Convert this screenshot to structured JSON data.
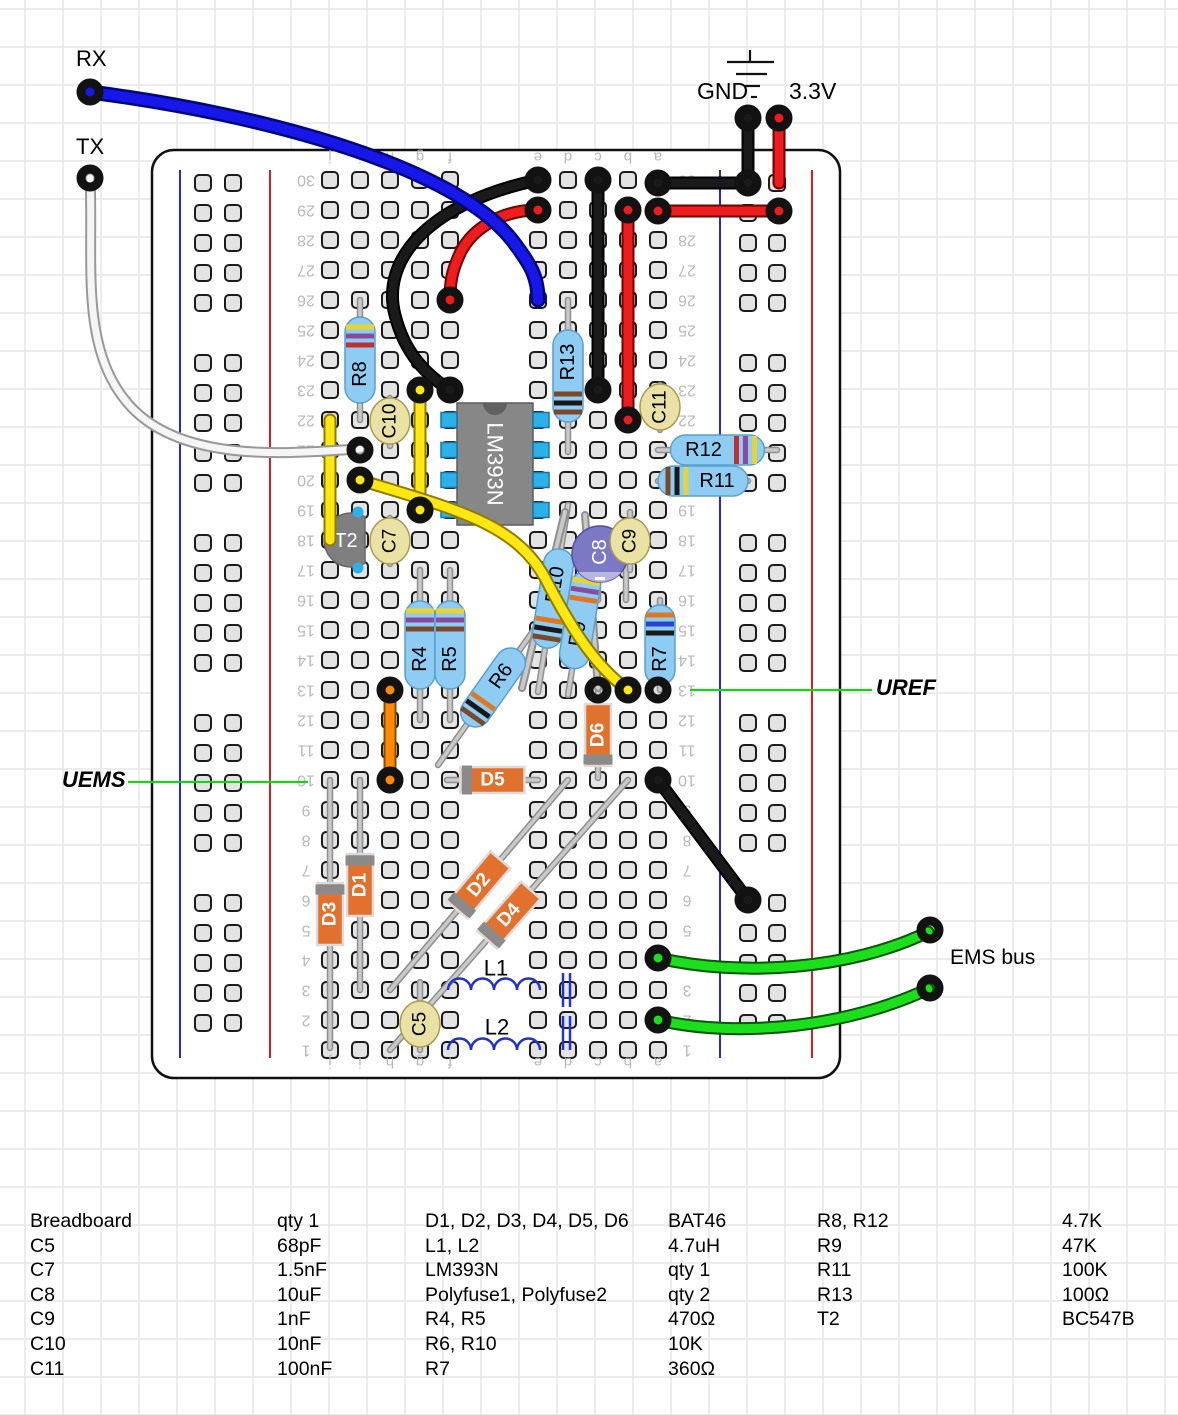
{
  "annotations": {
    "rx": "RX",
    "tx": "TX",
    "gnd": "GND",
    "v33": "3.3V",
    "uems": "UEMS",
    "uref": "UREF",
    "ems_bus": "EMS bus"
  },
  "board": {
    "x": 152,
    "y": 150,
    "w": 688,
    "h": 928,
    "column_letters": [
      "j",
      "i",
      "h",
      "g",
      "f",
      "e",
      "d",
      "c",
      "b",
      "a"
    ],
    "columns_x": [
      330,
      360,
      390,
      420,
      450,
      538,
      568,
      598,
      628,
      658
    ],
    "row_count": 30
  },
  "components": [
    {
      "id": "ic1",
      "kind": "ic",
      "label": "LM393N",
      "x": 457,
      "y": 403,
      "w": 76,
      "h": 122,
      "pinRows": [
        420,
        450,
        480,
        510
      ]
    },
    {
      "id": "r8",
      "kind": "resistor",
      "label": "R8",
      "lead": [
        360,
        300,
        360,
        420
      ],
      "body": 86,
      "bands": [
        "#e8d430",
        "#8b4a9e",
        "#c03030"
      ],
      "bandsAt": "start"
    },
    {
      "id": "r13",
      "kind": "resistor",
      "label": "R13",
      "lead": [
        568,
        300,
        568,
        452
      ],
      "body": 92,
      "bands": [
        "#7a4a28",
        "#191919",
        "#7a4a28"
      ],
      "bandsAt": "end"
    },
    {
      "id": "r12",
      "kind": "resistor",
      "label": "R12",
      "lead": [
        658,
        450,
        777,
        450
      ],
      "body": 94,
      "bands": [
        "#e8d430",
        "#8b4a9e",
        "#c03030"
      ],
      "bandsAt": "end"
    },
    {
      "id": "r11",
      "kind": "resistor",
      "label": "R11",
      "lead": [
        658,
        481,
        748,
        481
      ],
      "body": 90,
      "bands": [
        "#7a4a28",
        "#191919",
        "#e8d430"
      ],
      "bandsAt": "start"
    },
    {
      "id": "r4",
      "kind": "resistor",
      "label": "R4",
      "lead": [
        420,
        570,
        420,
        720
      ],
      "body": 88,
      "bands": [
        "#e8d430",
        "#8b4a9e",
        "#7a4a28"
      ],
      "bandsAt": "start"
    },
    {
      "id": "r5",
      "kind": "resistor",
      "label": "R5",
      "lead": [
        450,
        570,
        450,
        720
      ],
      "body": 88,
      "bands": [
        "#e8d430",
        "#8b4a9e",
        "#7a4a28"
      ],
      "bandsAt": "start"
    },
    {
      "id": "r6",
      "kind": "resistor",
      "label": "R6",
      "lead": [
        438,
        765,
        548,
        610
      ],
      "body": 90,
      "bands": [
        "#7a4a28",
        "#191919",
        "#e07820"
      ],
      "bandsAt": "start"
    },
    {
      "id": "r10",
      "kind": "resistor",
      "label": "R10",
      "lead": [
        568,
        505,
        538,
        692
      ],
      "body": 100,
      "bands": [
        "#7a4a28",
        "#191919",
        "#e07820"
      ],
      "bandsAt": "end"
    },
    {
      "id": "r9",
      "kind": "resistor",
      "label": "R9",
      "lead": [
        592,
        545,
        568,
        695
      ],
      "body": 98,
      "bands": [
        "#e8d430",
        "#8b4a9e",
        "#e07820"
      ],
      "bandsAt": "start"
    },
    {
      "id": "r7",
      "kind": "resistor",
      "label": "R7",
      "lead": [
        660,
        600,
        660,
        690
      ],
      "body": 80,
      "bands": [
        "#e07820",
        "#2743cf",
        "#191919"
      ],
      "bandsAt": "start"
    },
    {
      "id": "d5",
      "kind": "diode",
      "label": "D5",
      "lead": [
        447,
        780,
        538,
        780
      ],
      "body": 64,
      "capAt": "start"
    },
    {
      "id": "d6",
      "kind": "diode",
      "label": "D6",
      "lead": [
        598,
        692,
        598,
        778
      ],
      "body": 62,
      "capAt": "end"
    },
    {
      "id": "d1",
      "kind": "diode",
      "label": "D1",
      "lead": [
        360,
        780,
        360,
        990
      ],
      "body": 62,
      "capAt": "start"
    },
    {
      "id": "d3",
      "kind": "diode",
      "label": "D3",
      "lead": [
        330,
        780,
        330,
        1048
      ],
      "body": 62,
      "capAt": "start"
    },
    {
      "id": "d2",
      "kind": "diode",
      "label": "D2",
      "lead": [
        568,
        780,
        390,
        990
      ],
      "body": 66,
      "capAt": "end"
    },
    {
      "id": "d4",
      "kind": "diode",
      "label": "D4",
      "lead": [
        628,
        780,
        390,
        1050
      ],
      "body": 66,
      "capAt": "end"
    },
    {
      "id": "t2",
      "kind": "transistor",
      "label": "T2",
      "cx": 351,
      "cy": 540,
      "r": 27,
      "dots": [
        [
          358,
          512
        ],
        [
          358,
          568
        ],
        [
          329,
          540
        ]
      ]
    },
    {
      "id": "c8",
      "kind": "ecap",
      "label": "C8",
      "cx": 600,
      "cy": 554,
      "r": 28,
      "leads": [
        [
          598,
          556,
          598,
          600
        ],
        [
          626,
          556,
          626,
          600
        ]
      ]
    },
    {
      "id": "c10",
      "kind": "cap",
      "label": "C10",
      "cx": 390,
      "cy": 421,
      "lead": [
        390,
        398,
        390,
        446
      ]
    },
    {
      "id": "c7",
      "kind": "cap",
      "label": "C7",
      "cx": 390,
      "cy": 541,
      "lead": [
        390,
        518,
        390,
        564
      ]
    },
    {
      "id": "c9",
      "kind": "cap",
      "label": "C9",
      "cx": 630,
      "cy": 541,
      "lead": [
        630,
        512,
        630,
        570
      ]
    },
    {
      "id": "c11",
      "kind": "cap",
      "label": "C11",
      "cx": 660,
      "cy": 407,
      "lead": [
        660,
        385,
        660,
        430
      ]
    },
    {
      "id": "c5",
      "kind": "cap",
      "label": "C5",
      "cx": 420,
      "cy": 1024,
      "lead": [
        420,
        982,
        420,
        1050
      ]
    },
    {
      "id": "polyfuse1",
      "kind": "lead",
      "lead": [
        565,
        512,
        522,
        688
      ]
    },
    {
      "id": "polyfuse2",
      "kind": "lead",
      "lead": [
        585,
        515,
        598,
        688
      ]
    },
    {
      "id": "l1",
      "kind": "inductor",
      "label": "L1",
      "x": 448,
      "y": 990,
      "humps": 4,
      "r": 11.5,
      "bars": [
        563,
        570
      ],
      "barY": [
        973,
        1007
      ],
      "labelAt": [
        496,
        968
      ]
    },
    {
      "id": "l2",
      "kind": "inductor",
      "label": "L2",
      "x": 448,
      "y": 1050,
      "humps": 4,
      "r": 11.5,
      "bars": [
        563,
        570
      ],
      "barY": [
        1016,
        1050
      ],
      "labelAt": [
        497,
        1027
      ]
    }
  ],
  "wires": [
    {
      "id": "black-column-c",
      "color": "black",
      "w": "med",
      "path": "M598,180 L598,390"
    },
    {
      "id": "red-column-b",
      "color": "red",
      "w": "med",
      "path": "M628,210 L628,420"
    },
    {
      "id": "black-top-jumper",
      "color": "black",
      "w": "med",
      "path": "M538,180 C432,202 380,258 395,315 C405,355 428,376 450,390"
    },
    {
      "id": "red-top-jumper",
      "color": "red",
      "w": "med",
      "path": "M538,210 C498,210 468,232 458,258 C452,272 450,282 450,300"
    },
    {
      "id": "black-rail-row30",
      "color": "black",
      "w": "med",
      "path": "M658,183 L748,183"
    },
    {
      "id": "red-rail-row29",
      "color": "red",
      "w": "med",
      "path": "M658,211 L779,211"
    },
    {
      "id": "gnd-pin-wire",
      "color": "black",
      "w": "med",
      "path": "M748,118 L748,183"
    },
    {
      "id": "v33-pin-wire",
      "color": "red",
      "w": "med",
      "path": "M779,118 L779,183"
    },
    {
      "id": "yellow-j-column",
      "color": "yellow",
      "w": "med",
      "path": "M330,420 L330,540"
    },
    {
      "id": "yellow-g-column",
      "color": "yellow",
      "w": "med",
      "path": "M420,390 L420,510"
    },
    {
      "id": "yellow-curve",
      "color": "yellow",
      "w": "med",
      "path": "M360,480 C450,508 515,522 545,578 C567,620 592,664 628,690"
    },
    {
      "id": "orange-jumper",
      "color": "orange",
      "w": "med",
      "path": "M390,690 L390,780"
    },
    {
      "id": "black-diagonal",
      "color": "black",
      "w": "med",
      "path": "M658,780 L748,900"
    },
    {
      "id": "white-tx-wire",
      "color": "white",
      "w": "thin",
      "path": "M90,178 C94,260 78,352 132,408 C188,466 300,452 360,449"
    },
    {
      "id": "blue-rx-wire",
      "color": "blue",
      "w": "thick",
      "path": "M90,92 C270,115 455,168 512,240 C532,266 538,278 538,300"
    },
    {
      "id": "green-ems-top",
      "color": "green",
      "w": "med",
      "path": "M658,958 C740,977 850,970 928,932"
    },
    {
      "id": "green-ems-bottom",
      "color": "green",
      "w": "med",
      "path": "M658,1020 C740,1039 850,1026 928,989"
    }
  ],
  "rings": [
    [
      90,
      92
    ],
    [
      90,
      178
    ],
    [
      748,
      118
    ],
    [
      779,
      118
    ],
    [
      538,
      180
    ],
    [
      538,
      210
    ],
    [
      598,
      180
    ],
    [
      628,
      210
    ],
    [
      658,
      183
    ],
    [
      748,
      183
    ],
    [
      658,
      211
    ],
    [
      779,
      211
    ],
    [
      450,
      300
    ],
    [
      450,
      390
    ],
    [
      420,
      390
    ],
    [
      598,
      390
    ],
    [
      628,
      420
    ],
    [
      360,
      450
    ],
    [
      360,
      480
    ],
    [
      420,
      510
    ],
    [
      390,
      690
    ],
    [
      598,
      690
    ],
    [
      628,
      690
    ],
    [
      658,
      690
    ],
    [
      390,
      780
    ],
    [
      658,
      780
    ],
    [
      748,
      900
    ],
    [
      658,
      958
    ],
    [
      658,
      1020
    ],
    [
      930,
      930
    ],
    [
      930,
      988
    ]
  ],
  "annotation_lines": [
    [
      128,
      782,
      308,
      782
    ],
    [
      690,
      690,
      872,
      690
    ]
  ],
  "parts_list": {
    "groups": [
      {
        "rows": [
          [
            "Breadboard",
            "qty 1"
          ],
          [
            "C5",
            "68pF"
          ],
          [
            "C7",
            "1.5nF"
          ],
          [
            "C8",
            "10uF"
          ],
          [
            "C9",
            "1nF"
          ],
          [
            "C10",
            "10nF"
          ],
          [
            "C11",
            "100nF"
          ]
        ]
      },
      {
        "rows": [
          [
            "D1, D2, D3, D4, D5, D6",
            "BAT46"
          ],
          [
            "L1, L2",
            "4.7uH"
          ],
          [
            "LM393N",
            "qty 1"
          ],
          [
            "Polyfuse1, Polyfuse2",
            "qty 2"
          ],
          [
            "R4, R5",
            "470Ω"
          ],
          [
            "R6, R10",
            "10K"
          ],
          [
            "R7",
            "360Ω"
          ]
        ]
      },
      {
        "rows": [
          [
            "R8, R12",
            "4.7K"
          ],
          [
            "R9",
            "47K"
          ],
          [
            "R11",
            "100K"
          ],
          [
            "R13",
            "100Ω"
          ],
          [
            "T2",
            "BC547B"
          ]
        ]
      }
    ]
  }
}
